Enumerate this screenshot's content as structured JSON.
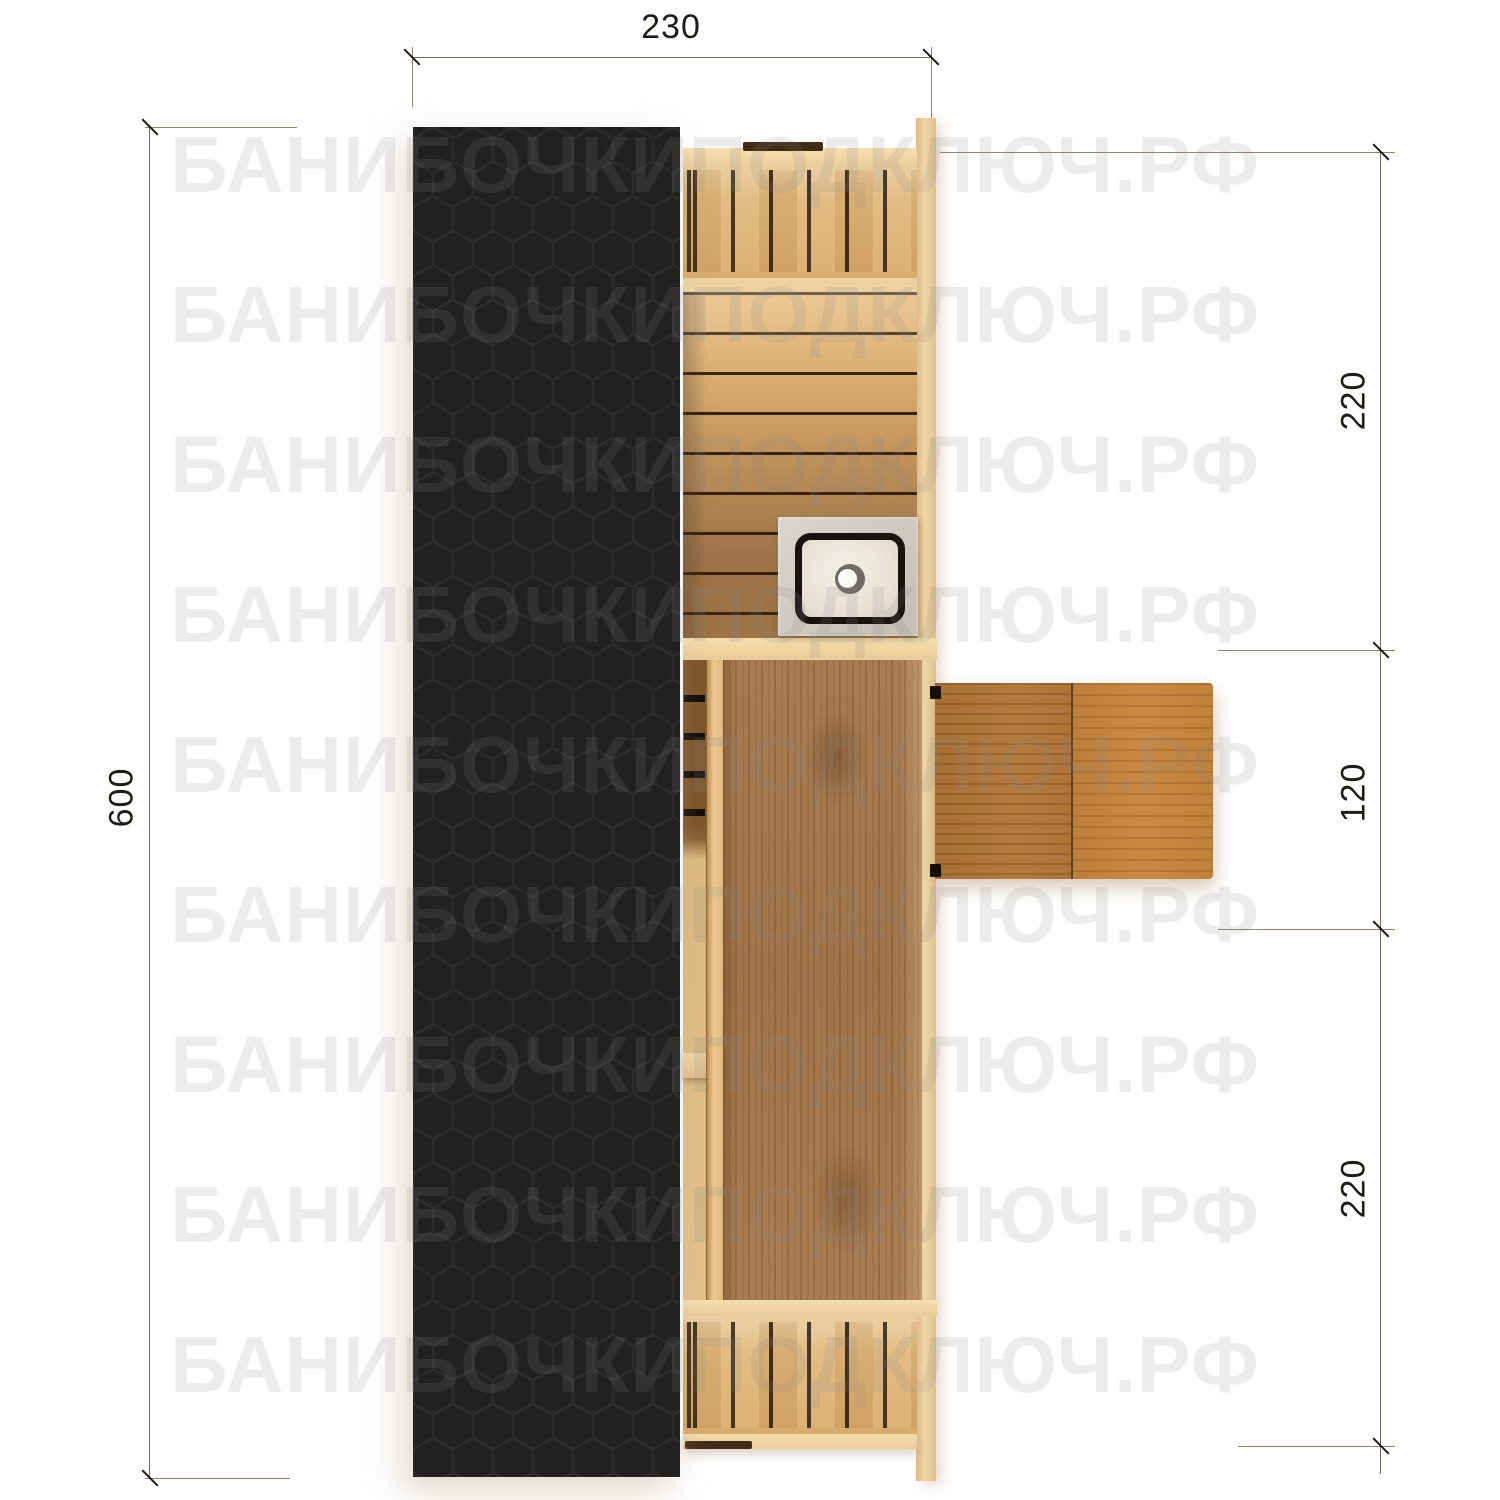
{
  "watermark": {
    "text": "БАНИБОЧКИПОДКЛЮЧ.РФ",
    "row_count": 9
  },
  "dimensions": {
    "top_width": {
      "label": "230"
    },
    "left_length": {
      "label": "600"
    },
    "right_segments": [
      {
        "label": "220"
      },
      {
        "label": "120"
      },
      {
        "label": "220"
      }
    ]
  },
  "colors": {
    "background": "#ffffff",
    "roof": "#232120",
    "roof_hex_line": "rgba(255,255,255,0.05)",
    "wood_rail": "#f3dcab",
    "wood_board": "#e2b97c",
    "wood_plank": "#d4a467",
    "wood_floor": "#a1744a",
    "table_wood_left": "#b57b3d",
    "table_wood_right": "#c98943",
    "sink_steel": "#cdc8c1",
    "basin_ring": "#17130f",
    "dimension_line": "#77685a",
    "dimension_tick": "#1d1813",
    "dimension_text": "#201c18",
    "watermark_gray": "rgba(136,136,136,0.16)"
  }
}
